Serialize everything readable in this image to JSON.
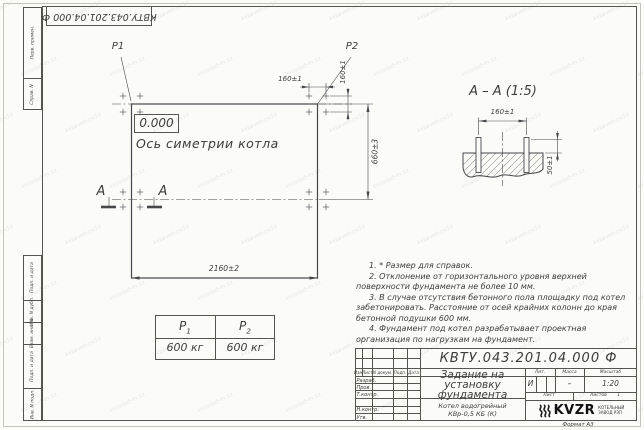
{
  "sheet": {
    "format_label": "Формат А3",
    "watermark_text": "kvzavod-nv.kz",
    "doc_number_inverted": "КВТУ.043.201.04.000 Ф"
  },
  "frame_margins": {
    "perv_primen": "Перв. примен.",
    "sprav_n": "Справ. N",
    "podp_data_1": "Подп. и дата",
    "inv_dubl": "Инв. N дубл.",
    "vzam_inv": "Взам. инв. N",
    "podp_data_2": "Подп. и дата",
    "inv_podl": "Инв. N подл."
  },
  "plan": {
    "load1_label": "P1",
    "load2_label": "P2",
    "elevation": "0.000",
    "axis_label": "Ось симетрии котла",
    "section_letter_left": "А",
    "section_letter_right": "А",
    "dim_width": "2160±2",
    "dim_rows": "660±3",
    "dim_bolt_h": "160±1",
    "dim_bolt_v": "160±1"
  },
  "section_view": {
    "title": "А – А (1:5)",
    "dim_bolt_spacing": "160±1",
    "dim_protrusion": "50±1"
  },
  "load_table": {
    "col1": {
      "base": "P",
      "sub": "1"
    },
    "col2": {
      "base": "P",
      "sub": "2"
    },
    "val1": "600 кг",
    "val2": "600 кг"
  },
  "notes": {
    "n1": "1. * Размер для справок.",
    "n2": "2. Отклонение от горизонтального уровня верхней поверхности фундамента не более 10 мм.",
    "n3": "3. В случае отсутствия бетонного пола площадку под котел забетонировать. Расстояние от осей крайних колонн до края бетонной подушки 600 мм.",
    "n4": "4. Фундамент под котел разрабатывает проектная организация по нагрузкам на фундамент."
  },
  "title_block": {
    "doc_number": "КВТУ.043.201.04.000 Ф",
    "title_line1": "Задание на",
    "title_line2": "установку",
    "title_line3": "фундамента",
    "product_line1": "Котел водогрейный",
    "product_line2": "КВр-0,5 КБ (К)",
    "col_izm": "Изм.",
    "col_list": "Лист",
    "col_ndoc": "N докум.",
    "col_podp": "Подп.",
    "col_data": "Дата",
    "row_razrab": "Разраб.",
    "row_prov": "Пров.",
    "row_tkontr": "Т.контр.",
    "row_nkontr": "Н.контр.",
    "row_utv": "Утв.",
    "lit_label": "Лит.",
    "mass_label": "Масса",
    "scale_label": "Масштаб",
    "lit_value": "И",
    "mass_value": "–",
    "scale_value": "1:20",
    "sheet_label": "Лист",
    "sheets_label": "Листов",
    "sheets_value": "1",
    "logo_text": "KVZR",
    "logo_sub1": "КОТЕЛЬНЫЙ",
    "logo_sub2": "ЗАВОД РЭП"
  }
}
